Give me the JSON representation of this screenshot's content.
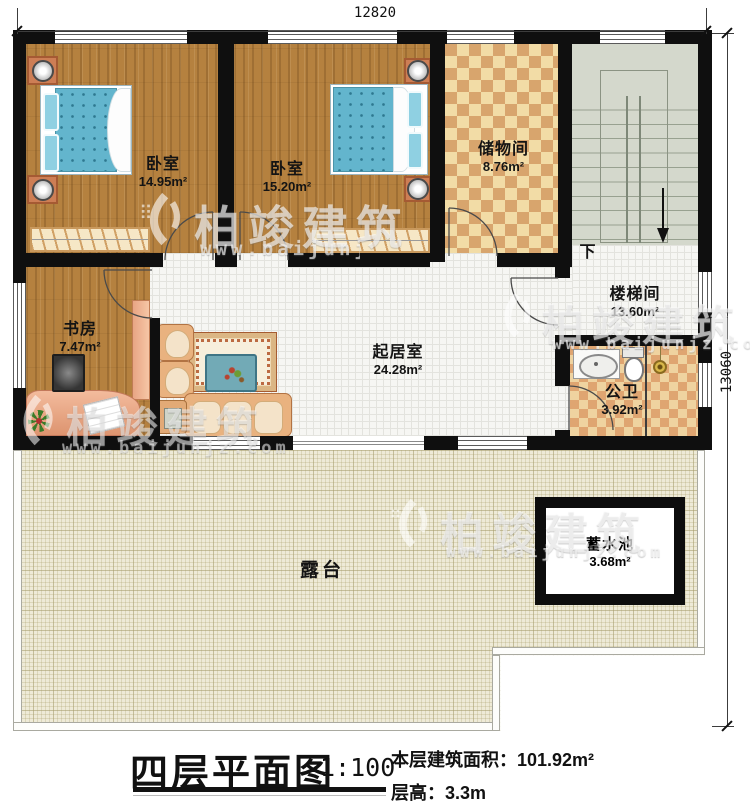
{
  "watermark": {
    "brand": "柏竣建筑",
    "url": "www.baijunjz.com"
  },
  "dimensions": {
    "top_width": "12820",
    "right_height": "13060"
  },
  "rooms": {
    "bedroom1": {
      "name": "卧室",
      "area": "14.95m²"
    },
    "bedroom2": {
      "name": "卧室",
      "area": "15.20m²"
    },
    "storage": {
      "name": "储物间",
      "area": "8.76m²"
    },
    "stairwell": {
      "name": "楼梯间",
      "area": "13.60m²"
    },
    "study": {
      "name": "书房",
      "area": "7.47m²"
    },
    "living": {
      "name": "起居室",
      "area": "24.28m²"
    },
    "bathroom": {
      "name": "公卫",
      "area": "3.92m²"
    },
    "terrace": {
      "name": "露台"
    },
    "water_tank": {
      "name": "蓄水池",
      "area": "3.68m²"
    }
  },
  "annotations": {
    "stairs_down": "下"
  },
  "title_block": {
    "title": "四层平面图",
    "scale": "1:100",
    "area_label": "本层建筑面积：",
    "area_value": "101.92m²",
    "height_label": "层高：",
    "height_value": "3.3m"
  }
}
